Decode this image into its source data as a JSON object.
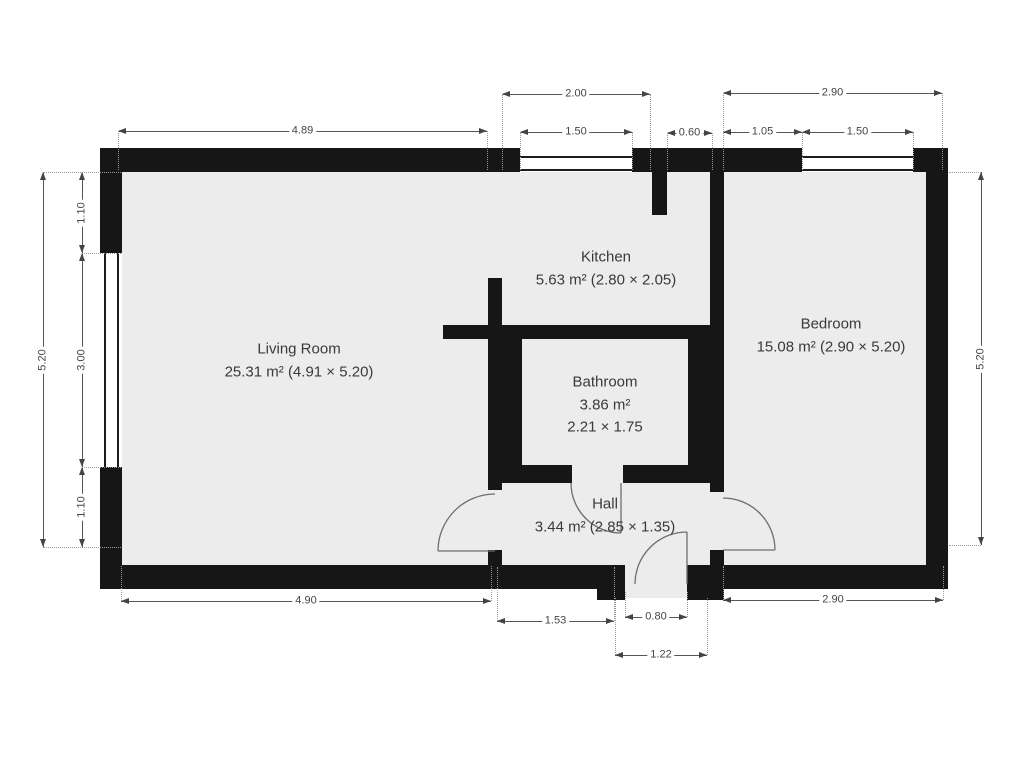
{
  "plan_title": "Apartment floor plan",
  "colors": {
    "wall": "#161616",
    "floor": "#ececec",
    "dim_line": "#555555",
    "dim_text": "#444444",
    "label_text": "#3a3a3a",
    "background": "#ffffff"
  },
  "rooms": [
    {
      "id": "living-room",
      "lines": [
        "Living Room",
        "25.31 m² (4.91 × 5.20)"
      ]
    },
    {
      "id": "kitchen",
      "lines": [
        "Kitchen",
        "5.63 m² (2.80 × 2.05)"
      ]
    },
    {
      "id": "bathroom",
      "lines": [
        "Bathroom",
        "3.86 m²",
        "2.21 × 1.75"
      ]
    },
    {
      "id": "bedroom",
      "lines": [
        "Bedroom",
        "15.08 m² (2.90 × 5.20)"
      ]
    },
    {
      "id": "hall",
      "lines": [
        "Hall",
        "3.44 m² (2.85 × 1.35)"
      ]
    }
  ],
  "dimensions": [
    {
      "label": "2.00",
      "o": "h",
      "x": 502,
      "y": 94,
      "len": 148,
      "ext": 76
    },
    {
      "label": "4.89",
      "o": "h",
      "x": 118,
      "y": 131,
      "len": 369,
      "ext": 39
    },
    {
      "label": "1.50",
      "o": "h",
      "x": 520,
      "y": 132,
      "len": 112,
      "ext": 38
    },
    {
      "label": "0.60",
      "o": "h",
      "x": 667,
      "y": 133,
      "len": 45,
      "ext": 37
    },
    {
      "label": "2.90",
      "o": "h",
      "x": 723,
      "y": 93,
      "len": 219,
      "ext": 77
    },
    {
      "label": "1.05",
      "o": "h",
      "x": 723,
      "y": 132,
      "len": 79,
      "ext": 38
    },
    {
      "label": "1.50",
      "o": "h",
      "x": 802,
      "y": 132,
      "len": 111,
      "ext": 38
    },
    {
      "label": "5.20",
      "o": "v",
      "x": 43,
      "y": 172,
      "len": 375,
      "ext": 56
    },
    {
      "label": "1.10",
      "o": "v",
      "x": 82,
      "y": 172,
      "len": 81,
      "ext": 39
    },
    {
      "label": "3.00",
      "o": "v",
      "x": 82,
      "y": 253,
      "len": 214,
      "ext": 39
    },
    {
      "label": "1.10",
      "o": "v",
      "x": 82,
      "y": 467,
      "len": 80,
      "ext": 39
    },
    {
      "label": "5.20",
      "o": "v",
      "x": 981,
      "y": 172,
      "len": 373,
      "ext": -32
    },
    {
      "label": "4.90",
      "o": "h",
      "x": 121,
      "y": 601,
      "len": 370,
      "ext": -35
    },
    {
      "label": "1.53",
      "o": "h",
      "x": 497,
      "y": 621,
      "len": 117,
      "ext": -54
    },
    {
      "label": "0.80",
      "o": "h",
      "x": 625,
      "y": 617,
      "len": 62,
      "ext": -25
    },
    {
      "label": "2.90",
      "o": "h",
      "x": 723,
      "y": 600,
      "len": 220,
      "ext": -34
    },
    {
      "label": "1.22",
      "o": "h",
      "x": 615,
      "y": 655,
      "len": 92,
      "ext": -57
    }
  ],
  "geometry": {
    "floors": [
      [
        122,
        172,
        804,
        393
      ],
      [
        615,
        565,
        72,
        33
      ]
    ],
    "walls": [
      [
        100,
        148,
        420,
        24
      ],
      [
        632,
        148,
        170,
        24
      ],
      [
        913,
        148,
        35,
        24
      ],
      [
        100,
        148,
        22,
        105
      ],
      [
        100,
        467,
        22,
        122
      ],
      [
        926,
        148,
        22,
        441
      ],
      [
        100,
        565,
        515,
        24
      ],
      [
        597,
        565,
        28,
        35
      ],
      [
        687,
        565,
        36,
        35
      ],
      [
        723,
        565,
        225,
        24
      ],
      [
        488,
        278,
        14,
        212
      ],
      [
        488,
        550,
        14,
        39
      ],
      [
        443,
        325,
        269,
        14
      ],
      [
        502,
        339,
        20,
        126
      ],
      [
        688,
        339,
        24,
        126
      ],
      [
        488,
        465,
        84,
        18
      ],
      [
        623,
        465,
        89,
        18
      ],
      [
        652,
        172,
        15,
        43
      ],
      [
        710,
        172,
        14,
        320
      ],
      [
        710,
        550,
        14,
        50
      ],
      [
        518,
        158,
        8,
        11
      ],
      [
        624,
        158,
        8,
        11
      ],
      [
        570,
        160,
        9,
        7
      ],
      [
        800,
        158,
        8,
        11
      ],
      [
        905,
        158,
        8,
        11
      ],
      [
        851,
        160,
        9,
        7
      ],
      [
        104,
        249,
        15,
        8
      ],
      [
        104,
        462,
        15,
        8
      ],
      [
        105,
        353,
        13,
        8
      ]
    ],
    "windows": [
      {
        "id": "kitchen-window",
        "o": "h",
        "x": 520,
        "y": 156,
        "w": 112,
        "h": 15
      },
      {
        "id": "bedroom-window",
        "o": "h",
        "x": 802,
        "y": 156,
        "w": 111,
        "h": 15
      },
      {
        "id": "living-room-window",
        "o": "v",
        "x": 104,
        "y": 253,
        "w": 15,
        "h": 214
      }
    ],
    "doors": [
      {
        "id": "living-room-hall-door",
        "arc": "M438,551 A57,57 0 0 1 495,494",
        "leaf": "M438,551 L495,551"
      },
      {
        "id": "bathroom-door",
        "arc": "M571,483 A50,50 0 0 0 621,533",
        "leaf": "M621,483 L621,533"
      },
      {
        "id": "bedroom-door",
        "arc": "M723,498 A52,52 0 0 1 775,550",
        "leaf": "M723,550 L775,550"
      },
      {
        "id": "entrance-door",
        "arc": "M635,584 A52,52 0 0 1 687,532",
        "leaf": "M687,532 L687,584"
      }
    ]
  }
}
